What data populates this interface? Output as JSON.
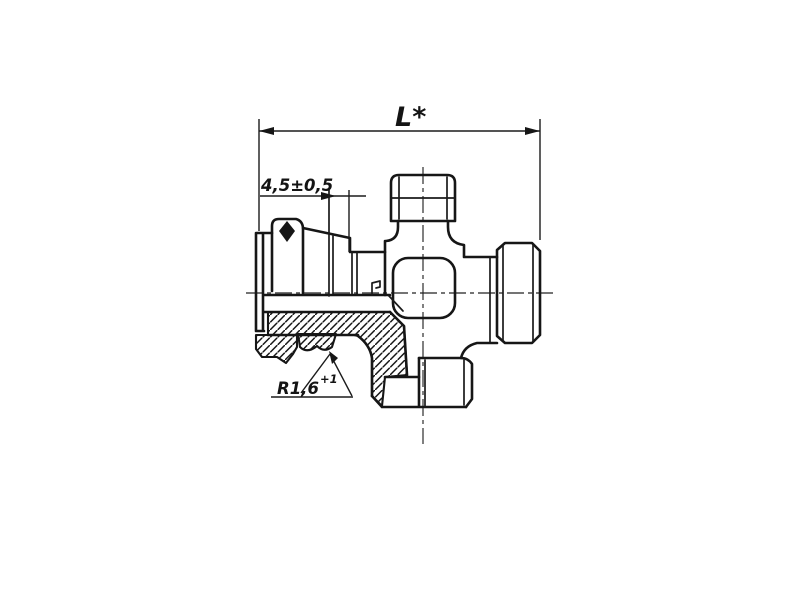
{
  "canvas": {
    "background": "#ffffff",
    "line_color": "#161616",
    "description": "Sectioned technical drawing of a cross pipe fitting with union nut"
  },
  "annotations": {
    "overall_length": "L*",
    "nut_gap": "4,5±0,5",
    "fillet_radius": "R1,6",
    "fillet_radius_tolerance": "+1"
  }
}
